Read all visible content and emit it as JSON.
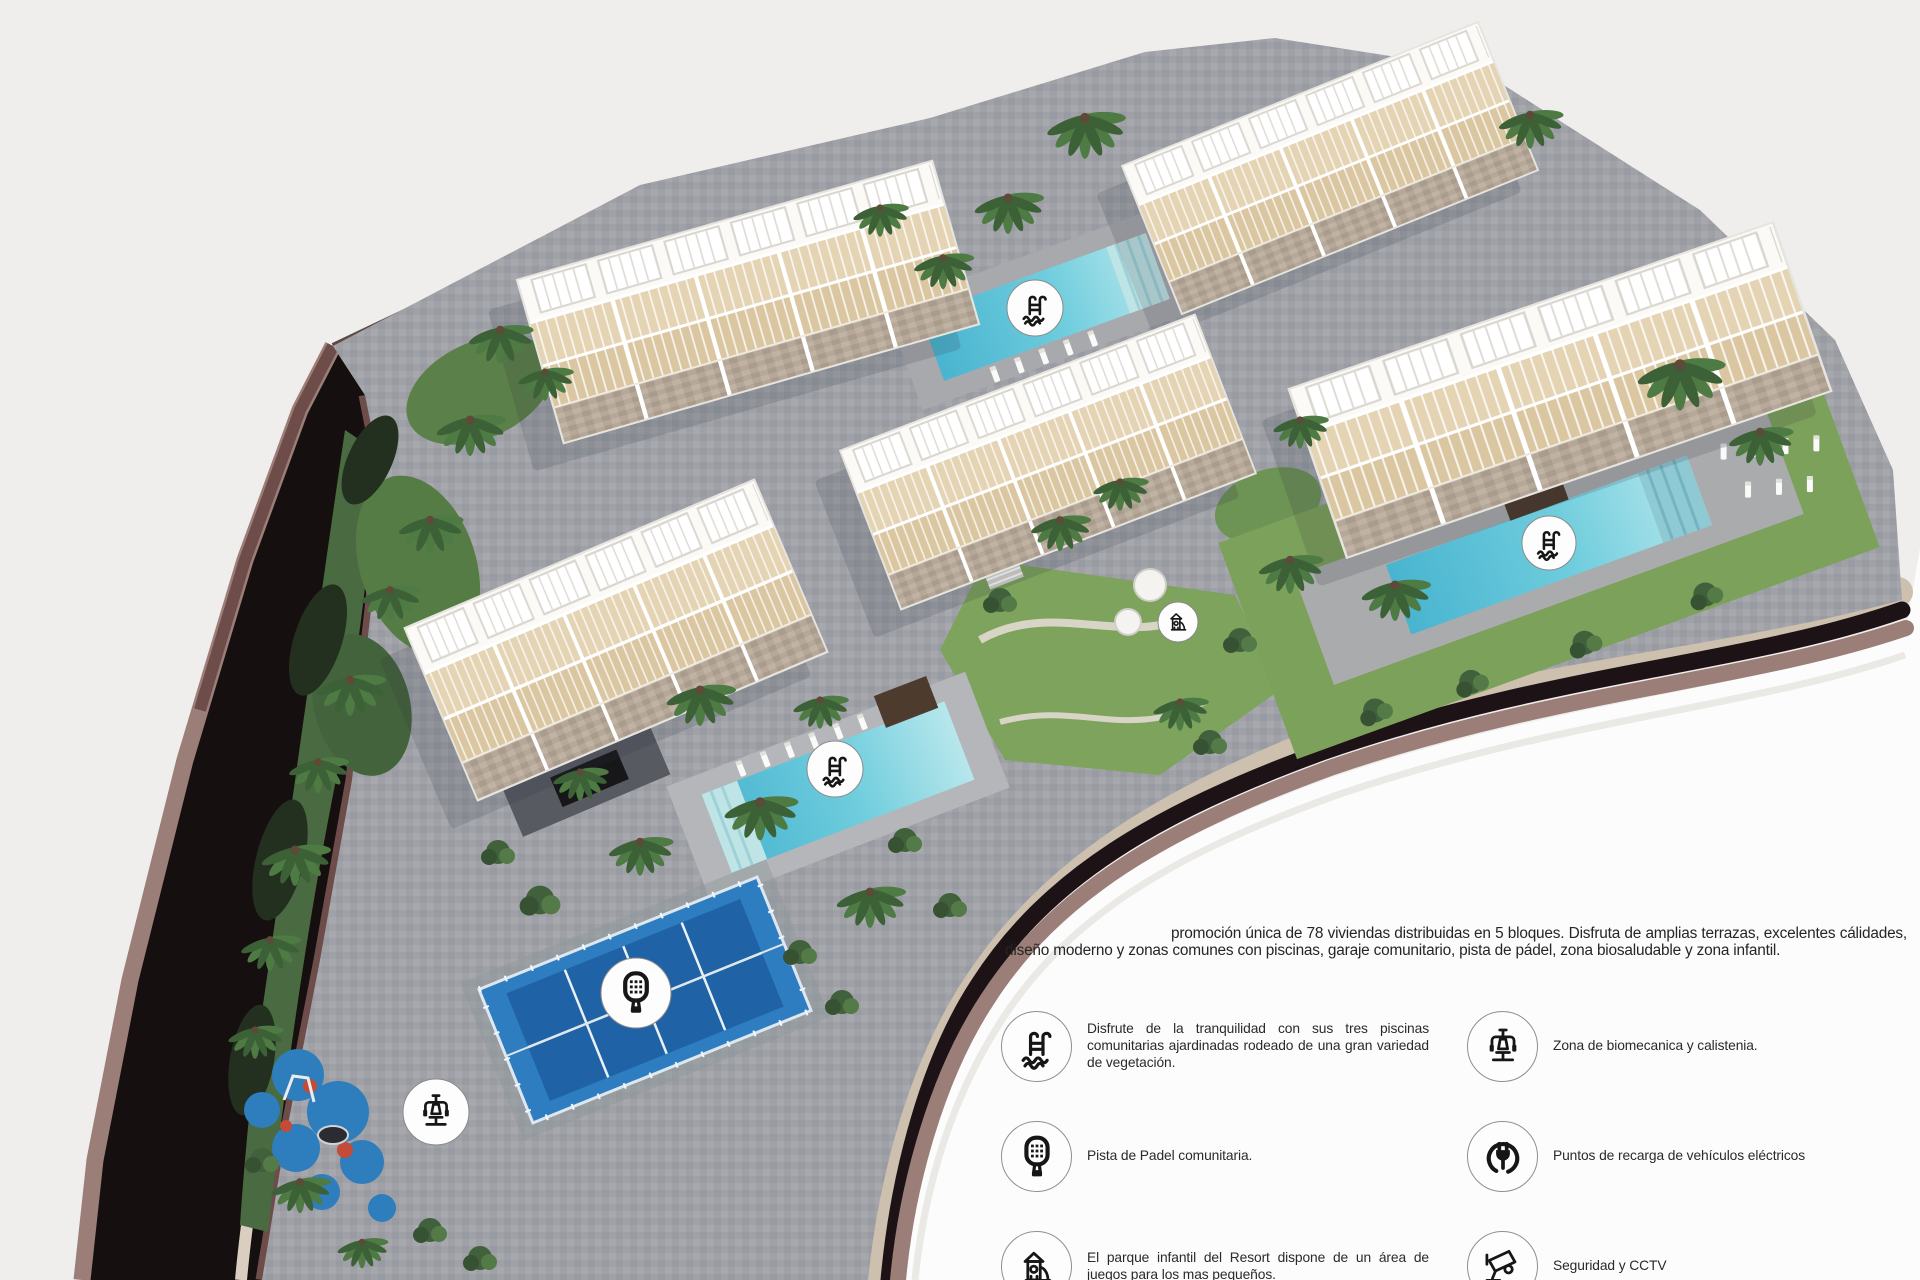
{
  "page": {
    "kind": "real-estate-resort-siteplan-render",
    "language": "es"
  },
  "description": {
    "text": "promoción única de 78 viviendas distribuidas en 5 bloques. Disfruta de amplias terrazas, excelentes cálidades, diseño moderno y zonas comunes con piscinas, garaje comunitario, pista de pádel, zona biosaludable y zona infantil."
  },
  "legend": {
    "left": [
      {
        "id": "pools",
        "icon": "ic-pool",
        "text": "Disfrute de la tranquilidad con sus tres piscinas comunitarias ajardinadas rodeado de una gran variedad de vegetación."
      },
      {
        "id": "padel",
        "icon": "ic-padel",
        "text": "Pista de Padel comunitaria."
      },
      {
        "id": "playground",
        "icon": "ic-playground",
        "text": "El parque infantil del Resort dispone de un área de juegos para los mas pequeños."
      }
    ],
    "right": [
      {
        "id": "gym",
        "icon": "ic-gym",
        "text": "Zona de biomecanica y calistenia."
      },
      {
        "id": "ev-charging",
        "icon": "ic-plug",
        "text": "Puntos de recarga de vehículos eléctricos"
      },
      {
        "id": "cctv",
        "icon": "ic-cctv",
        "text": "Seguridad y CCTV"
      }
    ]
  },
  "site": {
    "markers": [
      {
        "name": "pool-marker-north",
        "icon": "ic-pool",
        "x": 1035,
        "y": 308,
        "r": 28
      },
      {
        "name": "pool-marker-east",
        "icon": "ic-pool",
        "x": 1549,
        "y": 543,
        "r": 27
      },
      {
        "name": "pool-marker-central",
        "icon": "ic-pool",
        "x": 835,
        "y": 769,
        "r": 28
      },
      {
        "name": "garden-playground-marker",
        "icon": "ic-playground",
        "x": 1178,
        "y": 622,
        "r": 20
      },
      {
        "name": "padel-court-marker",
        "icon": "ic-padel",
        "x": 636,
        "y": 993,
        "r": 35
      },
      {
        "name": "biohealthy-zone-marker",
        "icon": "ic-gym",
        "x": 436,
        "y": 1112,
        "r": 33
      }
    ]
  },
  "colors": {
    "background": "#f0eeec",
    "white_area": "#fcfcfd",
    "road_asphalt": "#15100f",
    "road_edge_dark": "#6d4c49",
    "road_edge_light": "#9c7e78",
    "paving": "#9fa1a7",
    "pool_water": "#5fc6da",
    "padel_blue": "#2e7dc0",
    "grass": "#7da35c",
    "building_white": "#f7f6f3",
    "terrace_beige": "#e0d0b0",
    "text": "#2b2a29"
  }
}
